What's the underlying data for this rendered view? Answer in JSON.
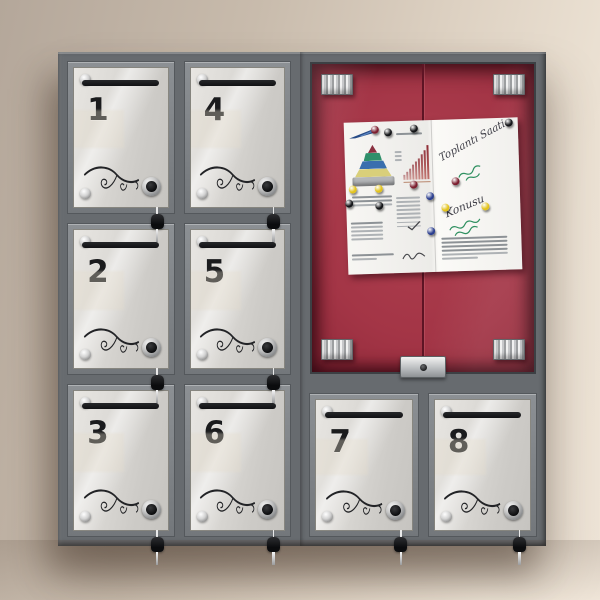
{
  "scene": {
    "description": "Wall-mounted metal mailbox cabinet with eight numbered glass doors and a central lockable notice display case",
    "wall_color": "#d8cbbc",
    "frame_color": "#6d7175",
    "glass_color": "#d6d4d0",
    "board_color": "#9e3344"
  },
  "mailboxes": [
    {
      "number": "1"
    },
    {
      "number": "4"
    },
    {
      "number": "2"
    },
    {
      "number": "5"
    },
    {
      "number": "3"
    },
    {
      "number": "6"
    },
    {
      "number": "7"
    },
    {
      "number": "8"
    }
  ],
  "display_case": {
    "hardware": {
      "corner_brackets": 4,
      "lock_type": "keyhole plate"
    },
    "notice_sheet": {
      "handwritten_title": "Toplantı Saati",
      "handwritten_topic": "Konusu",
      "pins": [
        {
          "color": "#7c1f2f",
          "x": 18,
          "y": 5
        },
        {
          "color": "#141518",
          "x": 25,
          "y": 7
        },
        {
          "color": "#141518",
          "x": 40,
          "y": 5
        },
        {
          "color": "#141518",
          "x": 95,
          "y": 3
        },
        {
          "color": "#e3c31c",
          "x": 4,
          "y": 44
        },
        {
          "color": "#e3c31c",
          "x": 19,
          "y": 44
        },
        {
          "color": "#7c1f2f",
          "x": 39,
          "y": 42
        },
        {
          "color": "#7c1f2f",
          "x": 63,
          "y": 41
        },
        {
          "color": "#141518",
          "x": 2,
          "y": 53
        },
        {
          "color": "#141518",
          "x": 19,
          "y": 55
        },
        {
          "color": "#2c3f8f",
          "x": 48,
          "y": 50
        },
        {
          "color": "#e3c31c",
          "x": 57,
          "y": 58
        },
        {
          "color": "#2c3f8f",
          "x": 48,
          "y": 73
        },
        {
          "color": "#e3c31c",
          "x": 80,
          "y": 58
        }
      ],
      "bar_chart": {
        "type": "bar",
        "relative_heights": [
          1.2,
          2,
          2.8,
          3.6,
          4.4,
          5.2,
          6.2,
          7.2,
          8.4
        ],
        "bar_color": "#a43a3a"
      },
      "pyramid_chart": {
        "type": "pyramid",
        "layer_colors": [
          "#8a3040",
          "#2f8f6a",
          "#3a6fae",
          "#d9cf7a",
          "#b4b6b8"
        ]
      }
    }
  }
}
